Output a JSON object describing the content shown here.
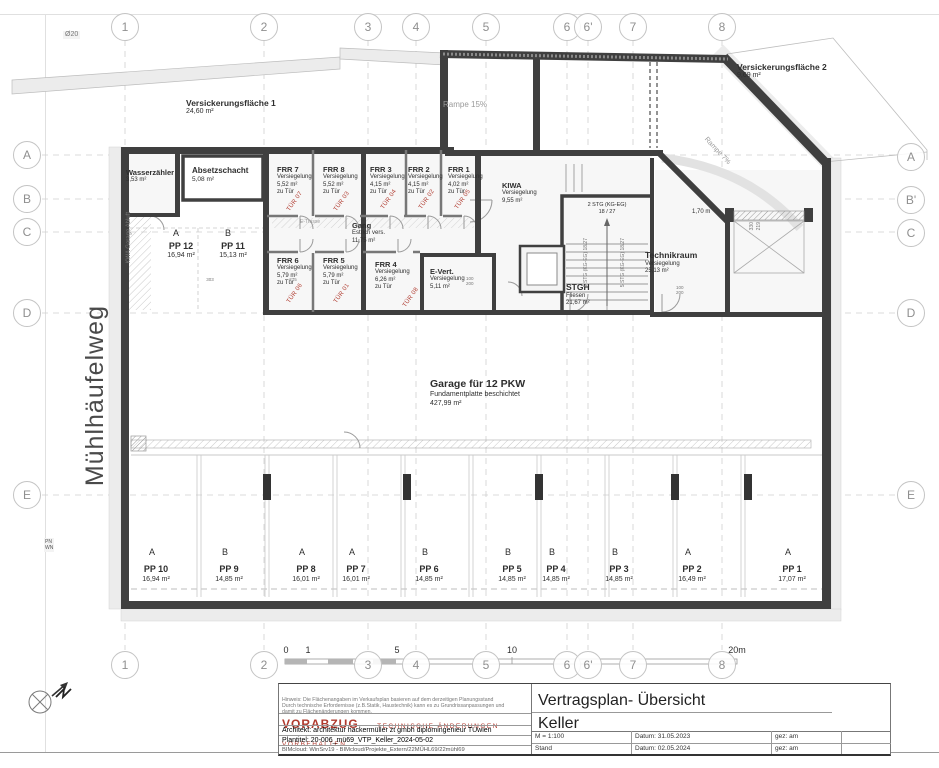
{
  "colors": {
    "wall": "#3f3f3f",
    "red_accent": "#b03a2e",
    "blue_note": "#5a6fae",
    "band": "#ececec"
  },
  "sheet": {
    "diameter_note": "Ø20",
    "street": "Mühlhäufelweg",
    "pn": "PN",
    "wn": "WN"
  },
  "grid": {
    "top": [
      "1",
      "2",
      "3",
      "4",
      "5",
      "6",
      "6'",
      "7",
      "8"
    ],
    "bottom": [
      "1",
      "2",
      "3",
      "4",
      "5",
      "6",
      "6'",
      "7",
      "8"
    ],
    "left": [
      "A",
      "B",
      "C",
      "D",
      "E"
    ],
    "right": [
      "A",
      "B'",
      "C",
      "D",
      "E"
    ]
  },
  "site": {
    "v1_name": "Versickerungsfläche 1",
    "v1_area": "24,60 m²",
    "v2_name": "Versickerungsfläche 2",
    "v2_area": "9,69 m²",
    "ramp15": "Rampe 15%",
    "ramp7": "Rampe 7%"
  },
  "rooms": {
    "wasser": {
      "name": "Wasserzähler",
      "area": "3,53 m²"
    },
    "absetz": {
      "name": "Absetzschacht",
      "area": "5,08 m²"
    },
    "frr7": {
      "name": "FRR 7",
      "seal": "Versiegelung",
      "area": "5,52 m²",
      "note": "zu Tür",
      "tuer": "TÜR 07"
    },
    "frr8": {
      "name": "FRR 8",
      "seal": "Versiegelung",
      "area": "5,52 m²",
      "note": "zu Tür",
      "tuer": "TÜR 03"
    },
    "frr3": {
      "name": "FRR 3",
      "seal": "Versiegelung",
      "area": "4,15 m²",
      "note": "zu Tür",
      "tuer": "TÜR 04"
    },
    "frr2": {
      "name": "FRR 2",
      "seal": "Versiegelung",
      "area": "4,15 m²",
      "note": "zu Tür",
      "tuer": "TÜR 02"
    },
    "frr1": {
      "name": "FRR 1",
      "seal": "Versiegelung",
      "area": "4,02 m²",
      "note": "zu Tür",
      "tuer": "TÜR 05"
    },
    "frr6": {
      "name": "FRR 6",
      "seal": "Versiegelung",
      "area": "5,79 m²",
      "note": "zu Tür",
      "tuer": "TÜR 06"
    },
    "frr5": {
      "name": "FRR 5",
      "seal": "Versiegelung",
      "area": "5,79 m²",
      "note": "zu Tür",
      "tuer": "TÜR 01"
    },
    "frr4": {
      "name": "FRR 4",
      "seal": "Versiegelung",
      "area": "6,26 m²",
      "note": "zu Tür",
      "tuer": "TÜR 08"
    },
    "gang": {
      "name": "Gang",
      "seal": "Estrich vers.",
      "area": "11,75 m²"
    },
    "kiwa": {
      "name": "KIWA",
      "seal": "Versiegelung",
      "area": "9,55 m²"
    },
    "evert": {
      "name": "E-Vert.",
      "seal": "Versiegelung",
      "area": "5,11 m²"
    },
    "stgh": {
      "name": "STGH",
      "seal": "Fliesen",
      "area": "21,67 m²"
    },
    "technik": {
      "name": "Technikraum",
      "seal": "Versiegelung",
      "area": "25,13 m²"
    },
    "garage": {
      "name": "Garage für 12 PKW",
      "seal": "Fundamentplatte beschichtet",
      "area": "427,99 m²"
    }
  },
  "stairs": {
    "upper": "2 STG (KG-EG)",
    "upper_ratio": "18 / 27",
    "flight": "5 STG (KG-EG) 18/27"
  },
  "annotations": {
    "kwa": "KWA Garage Abluft",
    "etrasse": "E-Trasse",
    "door_width": "1,70 m",
    "dim330": "330",
    "dim219": "219",
    "dim303": "303",
    "dim275": "275",
    "door100": "100",
    "door200": "200"
  },
  "parking": {
    "top": [
      {
        "type": "A",
        "code": "PP 12",
        "area": "16,94 m²"
      },
      {
        "type": "B",
        "code": "PP 11",
        "area": "15,13 m²"
      }
    ],
    "bottom": [
      {
        "type": "A",
        "code": "PP 10",
        "area": "16,94 m²"
      },
      {
        "type": "B",
        "code": "PP 9",
        "area": "14,85 m²"
      },
      {
        "type": "A",
        "code": "PP 8",
        "area": "16,01 m²"
      },
      {
        "type": "A",
        "code": "PP 7",
        "area": "16,01 m²"
      },
      {
        "type": "B",
        "code": "PP 6",
        "area": "14,85 m²"
      },
      {
        "type": "B",
        "code": "PP 5",
        "area": "14,85 m²"
      },
      {
        "type": "B",
        "code": "PP 4",
        "area": "14,85 m²"
      },
      {
        "type": "B",
        "code": "PP 3",
        "area": "14,85 m²"
      },
      {
        "type": "A",
        "code": "PP 2",
        "area": "16,49 m²"
      },
      {
        "type": "A",
        "code": "PP 1",
        "area": "17,07 m²"
      }
    ]
  },
  "scalebar": {
    "t0": "0",
    "t1": "1",
    "t5": "5",
    "t10": "10",
    "t20": "20m"
  },
  "titleblock": {
    "hinweis1": "Hinweis: Die Flächenangaben im Verkaufsplan basieren auf dem derzeitigen Planungsstand",
    "hinweis2": "Durch technische Erfordernisse (z.B.Statik, Haustechnik) kann es zu  Grundrissanpassungen und",
    "hinweis3": "damit zu Flächenänderungen kommen.",
    "vorabzug": "VORABZUG",
    "vorbehalt": "TECHNISCHE ÄNDERUNGEN VORBEHALTEN",
    "architekt": "Architekt:   architektur hackermüller zt gmbh diplomingenieur TUwien",
    "plantitel": "Plantitel:   20-006_mü69_VTP_Keller_2024-05-02",
    "bimcloud": "BIMcloud: WinSrv19 - BIMcloud/Projekte_Extern/22MÜHL69/22mühl69",
    "title": "Vertragsplan- Übersicht",
    "subtitle": "Keller",
    "scale": "M = 1:100",
    "datum1": "Datum:  31.05.2023",
    "gez1": "gez:  am",
    "stand": "Stand",
    "datum2": "Datum:  02.05.2024",
    "gez2": "gez:  am"
  }
}
